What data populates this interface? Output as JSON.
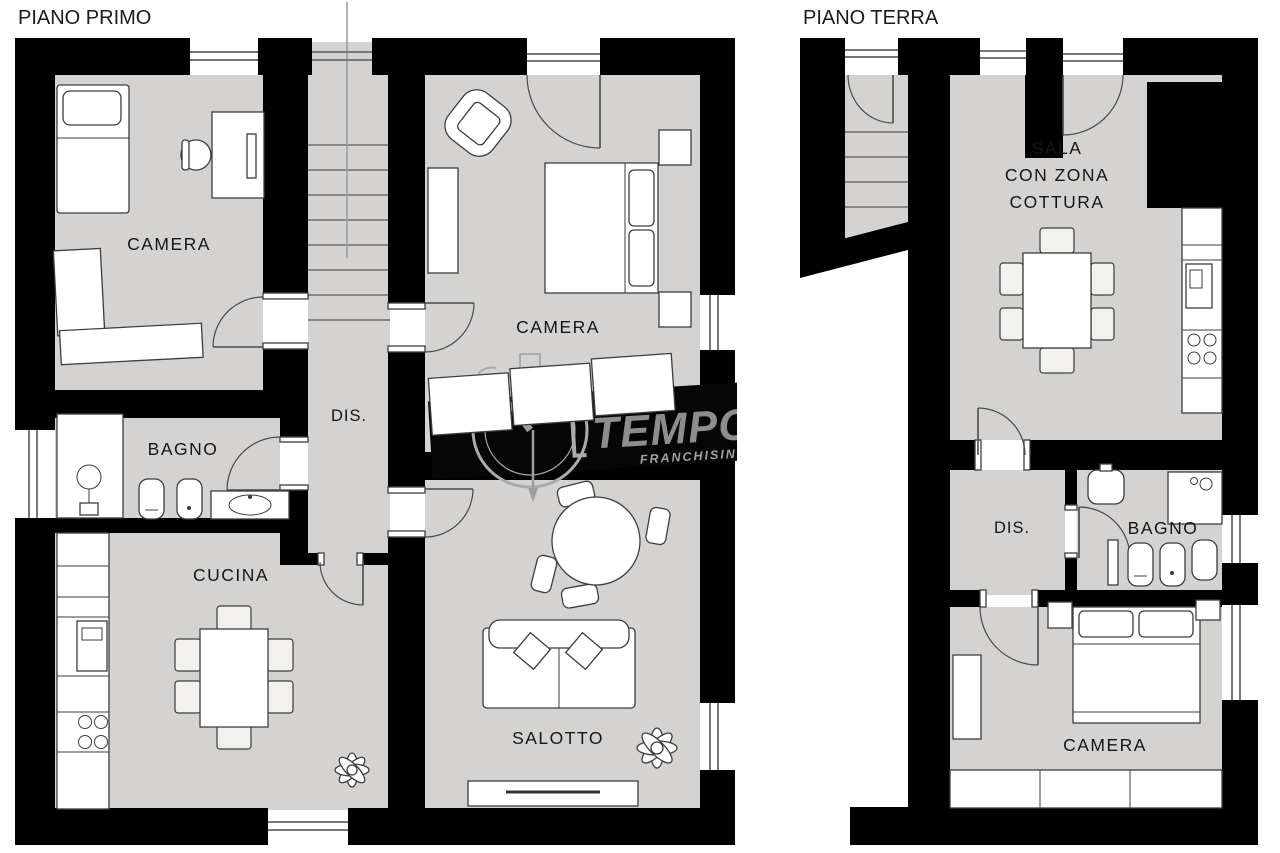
{
  "document_type": "floor-plan",
  "plans": [
    {
      "title": "PIANO PRIMO",
      "rooms": [
        {
          "id": "camera-nord",
          "label": "CAMERA"
        },
        {
          "id": "camera-sud",
          "label": "CAMERA"
        },
        {
          "id": "disimpegno",
          "label": "DIS."
        },
        {
          "id": "bagno",
          "label": "BAGNO"
        },
        {
          "id": "cucina",
          "label": "CUCINA"
        },
        {
          "id": "salotto",
          "label": "SALOTTO"
        }
      ],
      "features": [
        "staircase",
        "single-bed",
        "desk",
        "double-bed",
        "wardrobes",
        "shower",
        "toilet",
        "bidet",
        "sink",
        "kitchen-counter",
        "dining-table-6-chairs",
        "round-table-4-chairs",
        "sofa",
        "tv-stand",
        "plants"
      ]
    },
    {
      "title": "PIANO TERRA",
      "rooms": [
        {
          "id": "sala",
          "label": "SALA CON ZONA COTTURA",
          "label_lines": [
            "SALA",
            "CON ZONA",
            "COTTURA"
          ]
        },
        {
          "id": "disimpegno",
          "label": "DIS."
        },
        {
          "id": "bagno",
          "label": "BAGNO"
        },
        {
          "id": "camera",
          "label": "CAMERA"
        }
      ],
      "features": [
        "staircase",
        "entrance-door",
        "dining-table-6-chairs",
        "kitchen-counter",
        "shower",
        "sink",
        "toilet",
        "bidet",
        "double-bed",
        "wardrobe"
      ]
    }
  ],
  "watermark": {
    "brand": "TEMPOC",
    "subtitle": "FRANCHISING N"
  },
  "colors": {
    "background": "#ffffff",
    "floor": "#d4d3d1",
    "wall": "#000000",
    "furniture_fill": "#ffffff",
    "furniture_outline": "#3d3d3d",
    "watermark_band": "#060606",
    "watermark_text": "#8d8d8d"
  }
}
